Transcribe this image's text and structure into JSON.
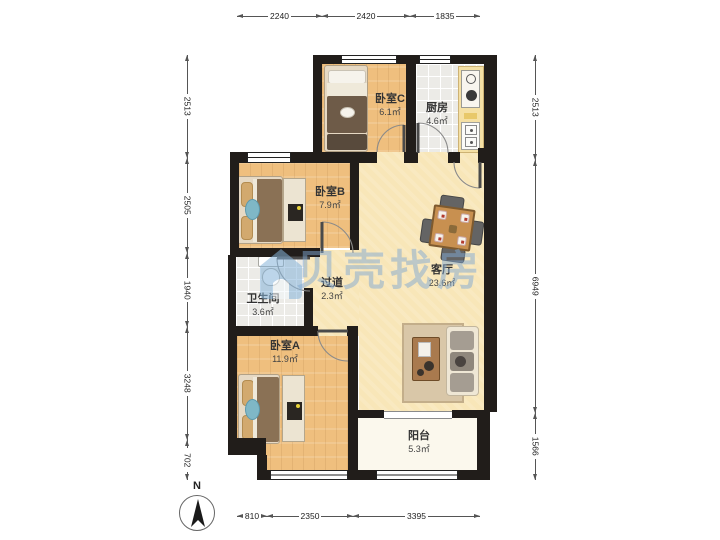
{
  "rooms": [
    {
      "name": "卧室C",
      "area": "6.1㎡"
    },
    {
      "name": "厨房",
      "area": "4.6㎡"
    },
    {
      "name": "卧室B",
      "area": "7.9㎡"
    },
    {
      "name": "过道",
      "area": "2.3㎡"
    },
    {
      "name": "客厅",
      "area": "23.6㎡"
    },
    {
      "name": "卫生间",
      "area": "3.6㎡"
    },
    {
      "name": "卧室A",
      "area": "11.9㎡"
    },
    {
      "name": "阳台",
      "area": "5.3㎡"
    }
  ],
  "dimensions": {
    "top": [
      "2240",
      "2420",
      "1835"
    ],
    "bottom": [
      "810",
      "2350",
      "3395"
    ],
    "left": [
      "2513",
      "2505",
      "1940",
      "3248",
      "702"
    ],
    "right": [
      "2513",
      "6949",
      "1566"
    ]
  },
  "compass": {
    "label": "N"
  },
  "watermark": {
    "text": "贝壳找房"
  },
  "colors": {
    "wall": "#211d1a",
    "wood_floor": "#efbf7e",
    "living_floor": "#f8e6b8",
    "tile_floor": "#ecebe7",
    "balcony_floor": "#fbf8ed",
    "watermark_blue": "#7fa8d2"
  }
}
